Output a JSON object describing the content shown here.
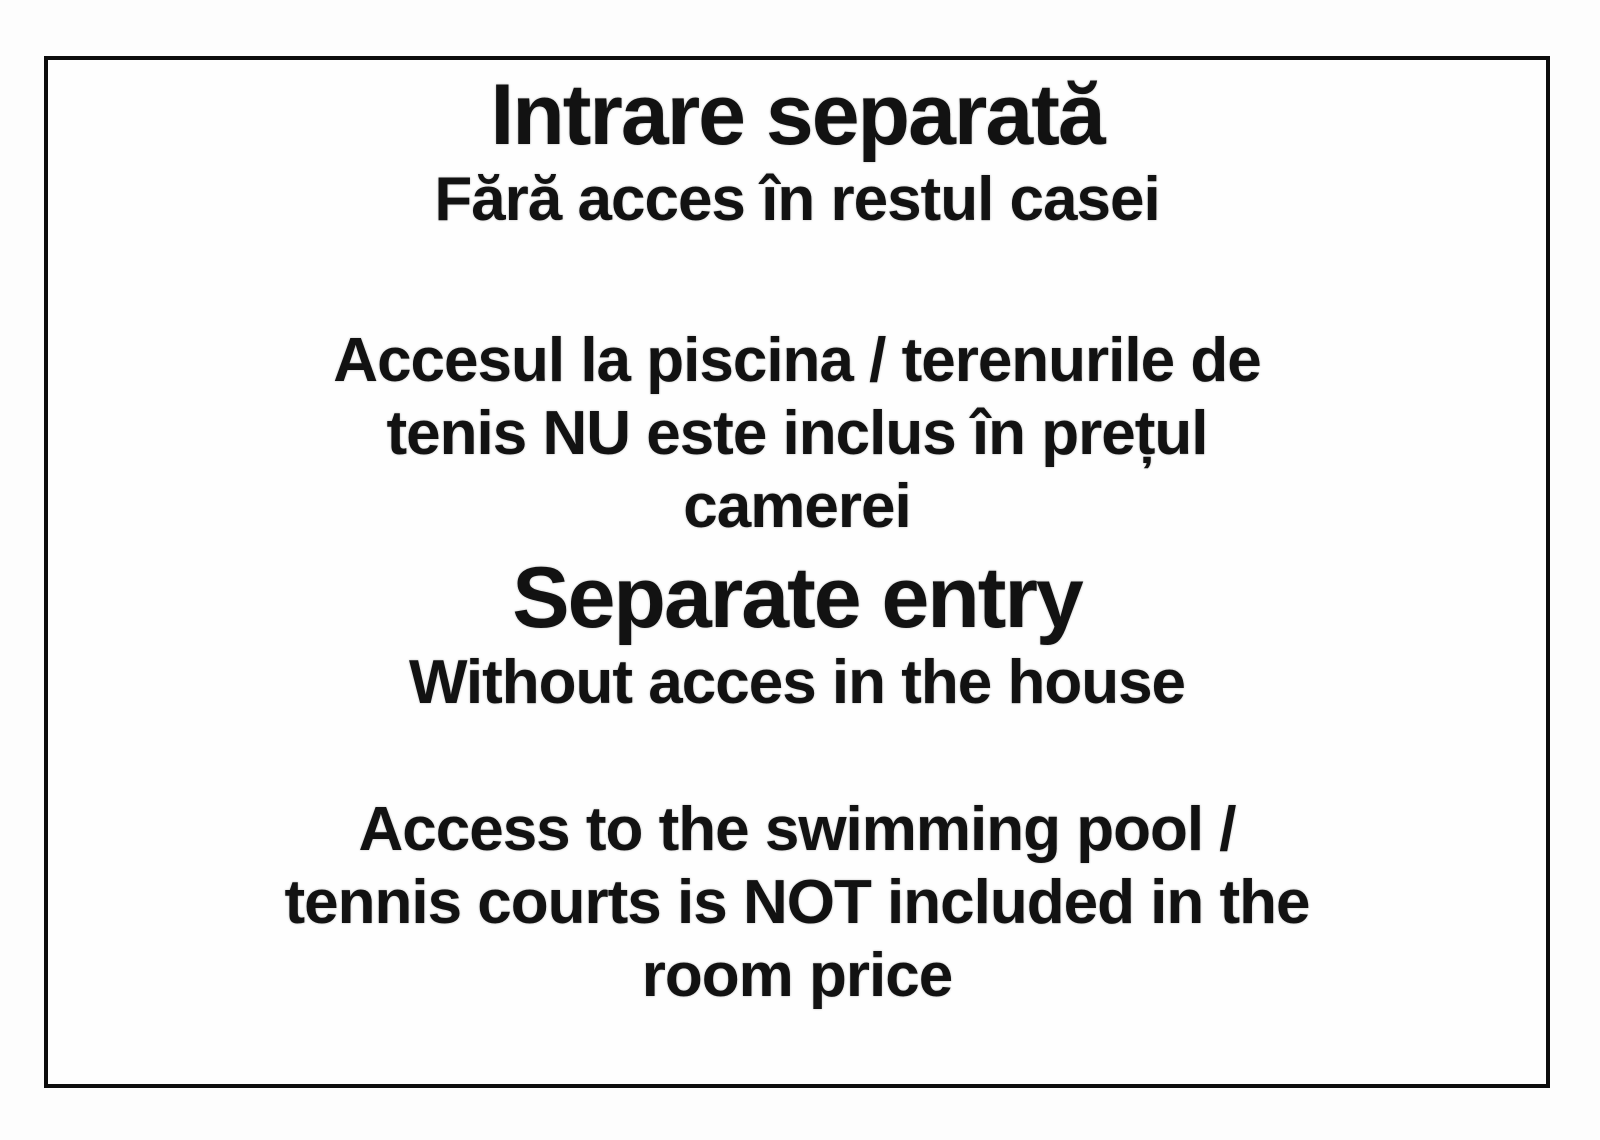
{
  "page": {
    "background_color": "#fdfdfd",
    "frame_border_color": "#0d0d0d",
    "text_color": "#121212"
  },
  "notice": {
    "romanian": {
      "title": "Intrare separată",
      "subtitle": "Fără acces în restul casei",
      "body_lines": [
        "Accesul la piscina / terenurile de",
        "tenis NU este inclus în prețul",
        "camerei"
      ]
    },
    "english": {
      "title": "Separate entry",
      "subtitle": "Without acces in the house",
      "body_lines": [
        "Access to the swimming pool /",
        "tennis courts is NOT included in the",
        "room price"
      ]
    }
  }
}
